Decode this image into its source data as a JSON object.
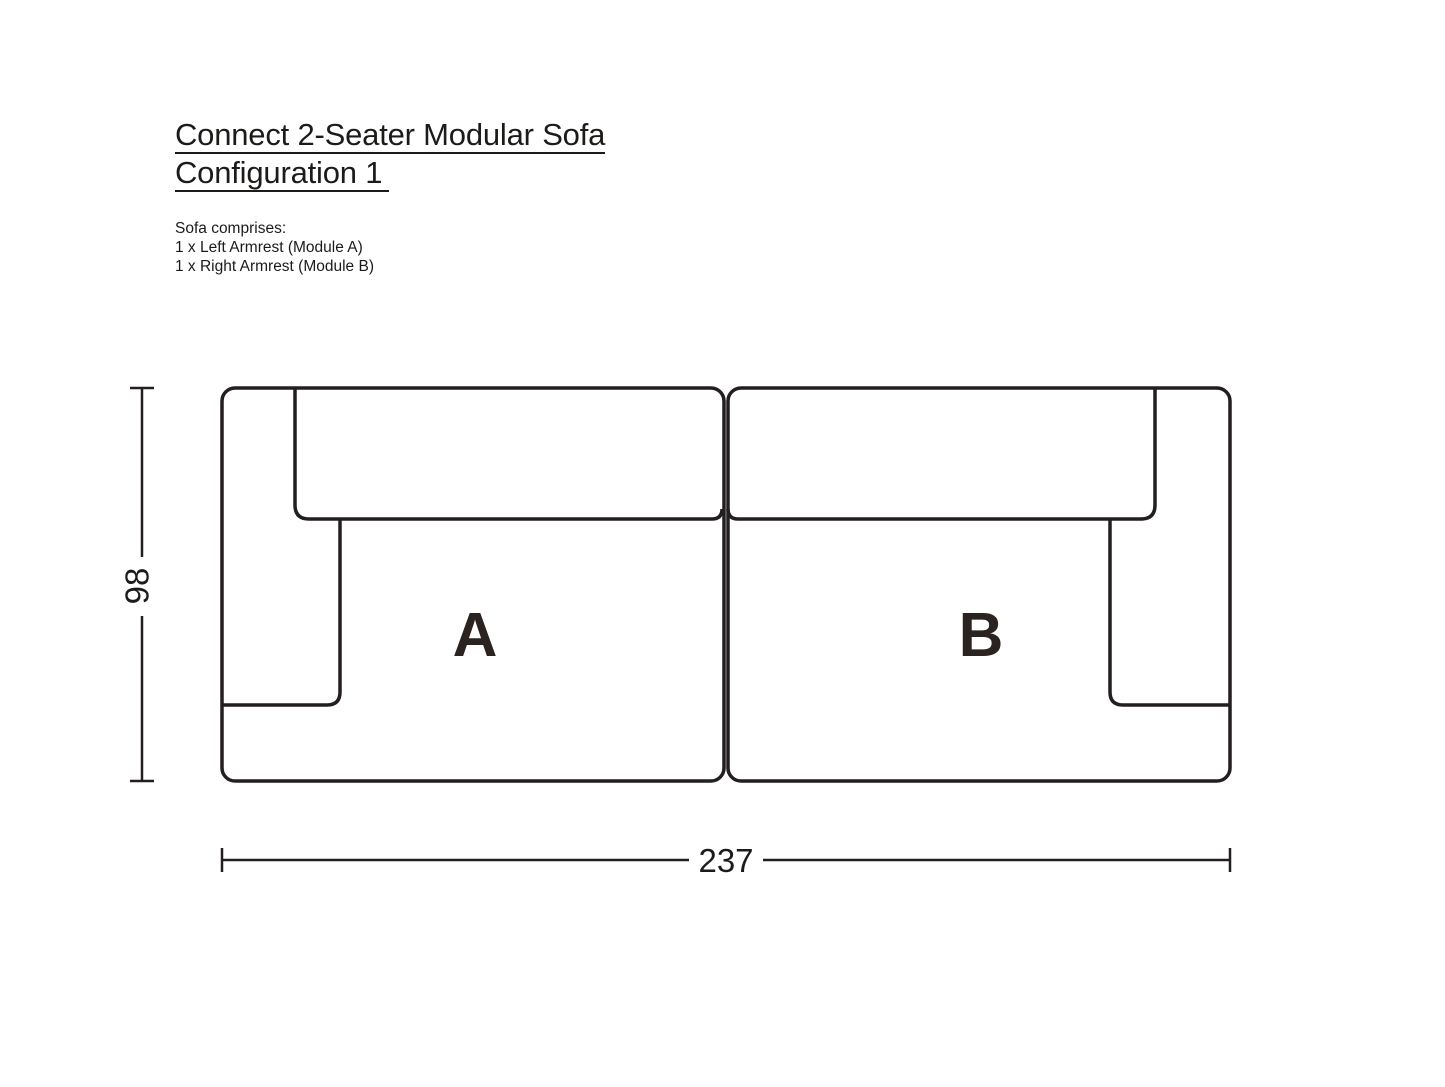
{
  "header": {
    "title_line1": "Connect 2-Seater Modular Sofa",
    "title_line2": "Configuration 1",
    "comprises_heading": "Sofa comprises:",
    "comprises_items": [
      "1 x Left Armrest (Module A)",
      "1 x Right Armrest (Module B)"
    ]
  },
  "diagram": {
    "modules": [
      {
        "label": "A"
      },
      {
        "label": "B"
      }
    ],
    "dimensions": {
      "depth": "98",
      "width": "237"
    },
    "line_color": "#231f20",
    "label_color": "#2b2320",
    "dimension_color": "#1d1b1a"
  }
}
